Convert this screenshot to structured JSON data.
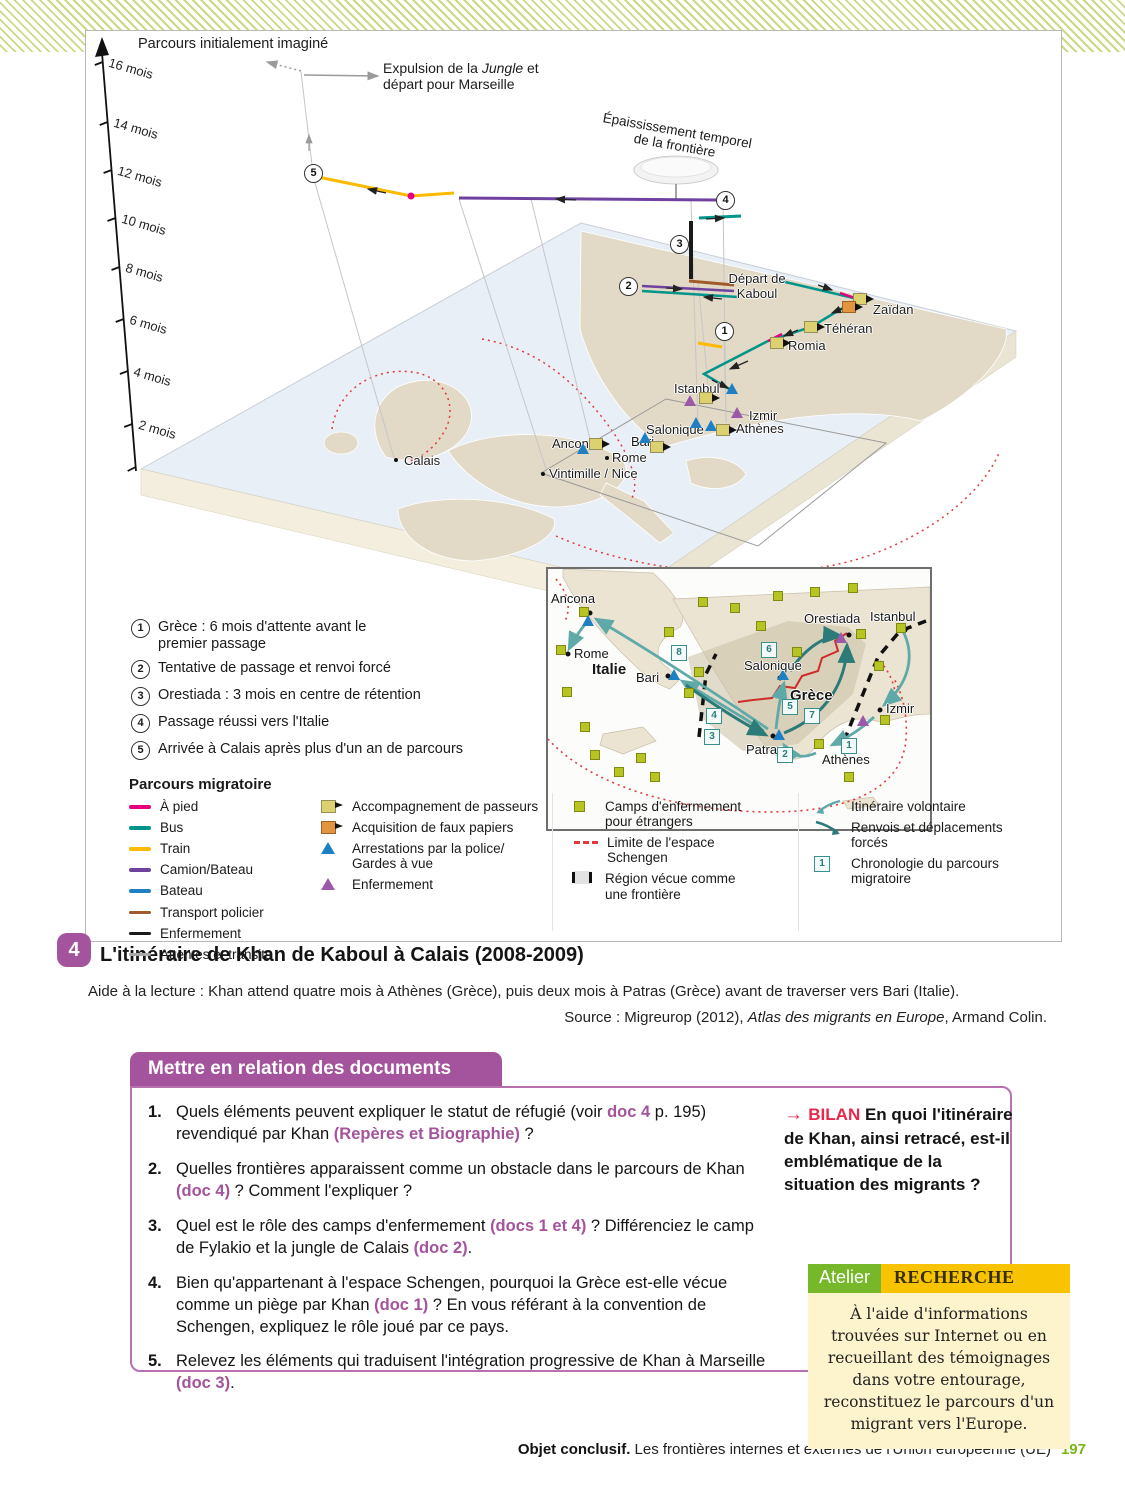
{
  "colors": {
    "accent_purple": "#a4549c",
    "bilan_red": "#e8274b",
    "atelier_green": "#76b82a",
    "recherche_yellow": "#f8c300",
    "panel_cream": "#fdf3cd",
    "page_green": "#7ab51d",
    "walk_pink": "#e6007e",
    "bus_teal": "#00958b",
    "train_yellow": "#fbba00",
    "truck_purple": "#6f42a0",
    "boat_blue": "#1e7fc2",
    "police_brown": "#a05a2c",
    "confinement_black": "#1a1a1a",
    "wait_gray": "#a8a8a8",
    "camp_olive": "#b8c423",
    "schengen_red": "#e03a3a",
    "voluntary_teal_light": "#5fa9a9",
    "forced_teal_dark": "#2c7b78"
  },
  "figure": {
    "axis_labels": [
      "16 mois",
      "14 mois",
      "12 mois",
      "10 mois",
      "8 mois",
      "6 mois",
      "4 mois",
      "2 mois"
    ],
    "annotations": {
      "initial": "Parcours initialement imaginé",
      "expulsion_pre": "Expulsion de la ",
      "expulsion_italic": "Jungle",
      "expulsion_post": " et",
      "expulsion_line2": "départ pour Marseille",
      "thickening_line1": "Épaississement temporel",
      "thickening_line2": "de la frontière"
    },
    "markers": [
      "1",
      "2",
      "3",
      "4",
      "5"
    ],
    "map": {
      "kaboul_line1": "Départ de",
      "kaboul_line2": "Kaboul",
      "zaidan": "Zaïdan",
      "teheran": "Téhéran",
      "romia": "Romia",
      "istanbul": "Istanbul",
      "izmir": "Izmir",
      "athenes": "Athènes",
      "salonique": "Salonique",
      "bari": "Bari",
      "rome": "Rome",
      "ancone": "Ancone",
      "vintimille": "Vintimille / Nice",
      "calais": "Calais"
    },
    "steps": [
      {
        "num": "1",
        "text": "Grèce : 6 mois d'attente avant le premier passage"
      },
      {
        "num": "2",
        "text": "Tentative de passage et renvoi forcé"
      },
      {
        "num": "3",
        "text": "Orestiada : 3 mois en centre de rétention"
      },
      {
        "num": "4",
        "text": "Passage réussi vers l'Italie"
      },
      {
        "num": "5",
        "text": "Arrivée à Calais après plus d'un an de parcours"
      }
    ],
    "inset": {
      "ancona": "Ancona",
      "rome": "Rome",
      "italie": "Italie",
      "bari": "Bari",
      "orestiada": "Orestiada",
      "istanbul": "Istanbul",
      "salonique": "Salonique",
      "grece": "Grèce",
      "izmir": "Izmir",
      "patras": "Patras",
      "athenes": "Athènes",
      "seq": [
        "1",
        "2",
        "3",
        "4",
        "5",
        "6",
        "7",
        "8"
      ]
    },
    "legend": {
      "title": "Parcours migratoire",
      "routes": [
        {
          "label": "À pied",
          "color": "#e6007e"
        },
        {
          "label": "Bus",
          "color": "#00958b"
        },
        {
          "label": "Train",
          "color": "#fbba00"
        },
        {
          "label": "Camion/Bateau",
          "color": "#6f42a0"
        },
        {
          "label": "Bateau",
          "color": "#1e7fc2"
        },
        {
          "label": "Transport policier",
          "color": "#a05a2c"
        },
        {
          "label": "Enfermement",
          "color": "#1a1a1a"
        },
        {
          "label": "Attentes et transits",
          "color": "#a8a8a8"
        }
      ],
      "events": [
        {
          "label": "Accompagnement de passeurs"
        },
        {
          "label": "Acquisition de faux papiers"
        },
        {
          "label": "Arrestations par la police/ Gardes à vue"
        },
        {
          "label": "Enfermement"
        }
      ],
      "areas": [
        {
          "label": "Camps d'enfermement pour étrangers"
        },
        {
          "label": "Limite de l'espace Schengen"
        },
        {
          "label": "Région vécue comme une frontière"
        }
      ],
      "movements": [
        {
          "label": "Itinéraire volontaire"
        },
        {
          "label": "Renvois et déplacements forcés"
        },
        {
          "label": "Chronologie du parcours migratoire",
          "box": "1"
        }
      ]
    }
  },
  "doc": {
    "number": "4",
    "title": "L'itinéraire de Khan de Kaboul à Calais (2008-2009)",
    "aide_label": "Aide à la lecture :",
    "aide_text": " Khan attend quatre mois à Athènes (Grèce), puis deux mois à Patras (Grèce) avant de traverser vers Bari (Italie).",
    "source_pre": "Source : Migreurop (2012), ",
    "source_italic": "Atlas des migrants en Europe",
    "source_post": ", Armand Colin."
  },
  "activity": {
    "banner": "Mettre en relation des documents",
    "questions": [
      {
        "num": "1.",
        "s1": "Quels éléments peuvent expliquer le statut de réfugié (voir ",
        "r1": "doc 4",
        "s2": " p. 195) revendiqué par Khan ",
        "r2": "(Repères et Biographie)",
        "s3": " ?"
      },
      {
        "num": "2.",
        "s1": "Quelles frontières apparaissent comme un obstacle dans le parcours de Khan ",
        "r1": "(doc 4)",
        "s2": " ? Comment l'expliquer ?"
      },
      {
        "num": "3.",
        "s1": "Quel est le rôle des camps d'enfermement ",
        "r1": "(docs 1 et 4)",
        "s2": " ? Différenciez le camp de Fylakio et la jungle de Calais ",
        "r2": "(doc 2)",
        "s3": "."
      },
      {
        "num": "4.",
        "s1": "Bien qu'appartenant à l'espace Schengen, pourquoi la Grèce est-elle vécue comme un piège par Khan ",
        "r1": "(doc 1)",
        "s2": " ? En vous référant à la convention de Schengen, expliquez le rôle joué par ce pays."
      },
      {
        "num": "5.",
        "s1": "Relevez les éléments qui traduisent l'intégration progressive de Khan à Marseille ",
        "r1": "(doc 3)",
        "s2": "."
      }
    ],
    "bilan": {
      "arrow": "→ ",
      "label": "BILAN",
      "text": " En quoi l'itinéraire de Khan, ainsi retracé, est-il emblématique de la situation des migrants ?"
    },
    "atelier": {
      "tag": "Atelier",
      "category": "RECHERCHE",
      "text": "À l'aide d'informations trouvées sur Internet ou en recueillant des témoignages dans votre entourage, reconstituez le parcours d'un migrant vers l'Europe."
    }
  },
  "footer": {
    "bold": "Objet conclusif.",
    "text": " Les frontières internes et externes de l'Union européenne (UE)",
    "page": "197"
  }
}
